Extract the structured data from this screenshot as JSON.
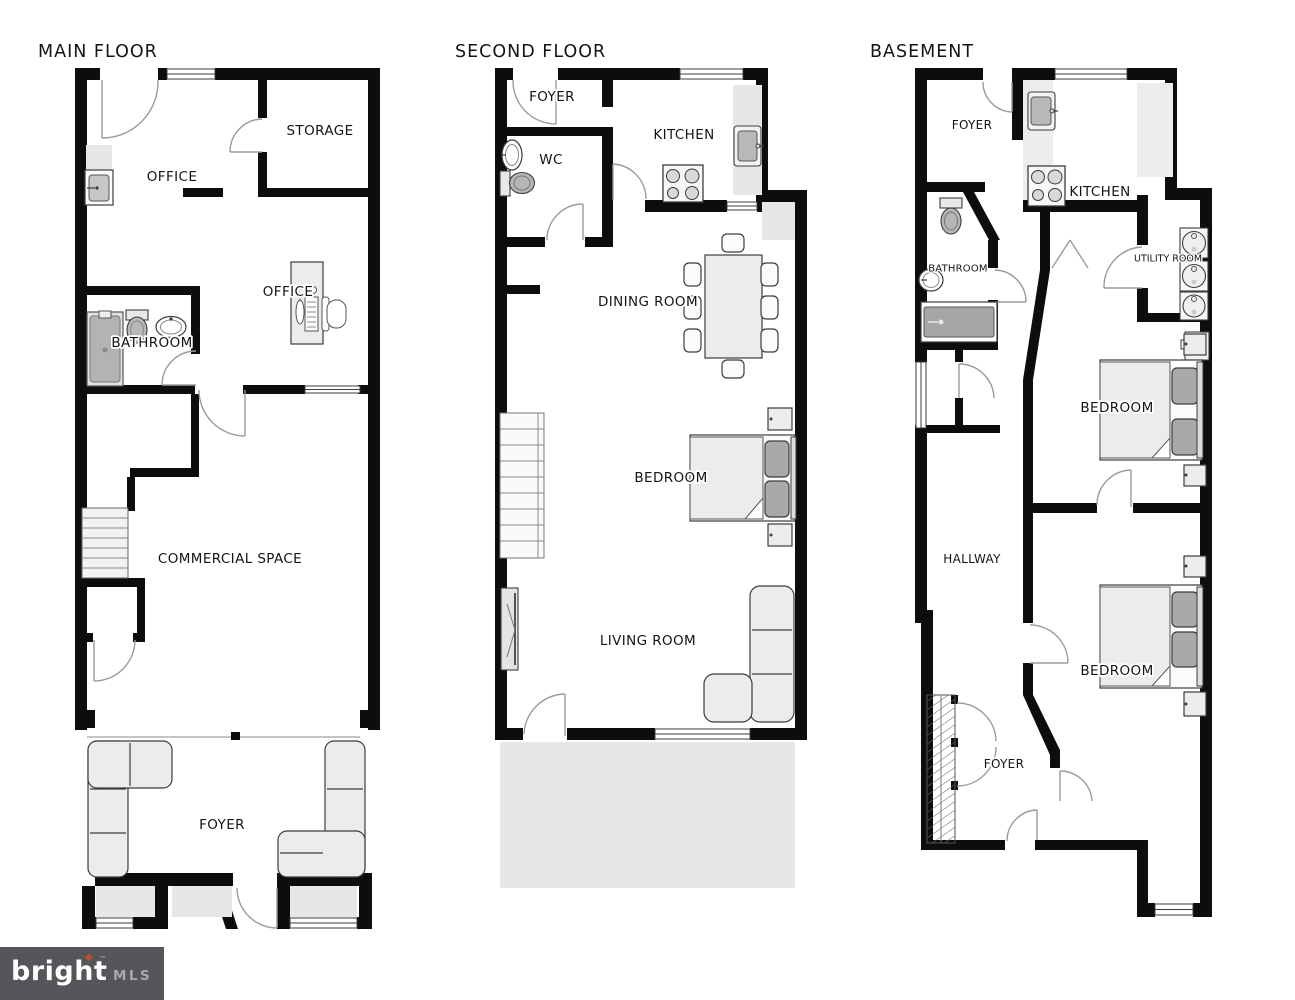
{
  "labels": {
    "main": {
      "title": "MAIN FLOOR",
      "storage": "STORAGE",
      "office_top": "OFFICE",
      "office_desk": "OFFICE",
      "bathroom": "BATHROOM",
      "commercial": "COMMERCIAL SPACE",
      "foyer": "FOYER"
    },
    "second": {
      "title": "SECOND FLOOR",
      "foyer": "FOYER",
      "wc": "WC",
      "kitchen": "KITCHEN",
      "dining": "DINING ROOM",
      "bedroom": "BEDROOM",
      "living": "LIVING ROOM"
    },
    "basement": {
      "title": "BASEMENT",
      "foyer_top": "FOYER",
      "kitchen": "KITCHEN",
      "bathroom": "BATHROOM",
      "utility": "UTILITY ROOM",
      "bedroom_top": "BEDROOM",
      "hallway": "HALLWAY",
      "bedroom_bottom": "BEDROOM",
      "foyer_bottom": "FOYER"
    },
    "logo": {
      "brand": "bright",
      "diamond": "◆",
      "tm": "™",
      "mls": "MLS"
    }
  },
  "colors": {
    "wall": "#0d0d0d",
    "furniture_light": "#ececec",
    "furniture_dark": "#a9a9a9",
    "floor_shade": "#e7e7e7",
    "logo_background": "#54565a",
    "logo_accent": "#c1502d",
    "logo_brand": "#ffffff",
    "logo_mls": "#a7a9ad"
  }
}
